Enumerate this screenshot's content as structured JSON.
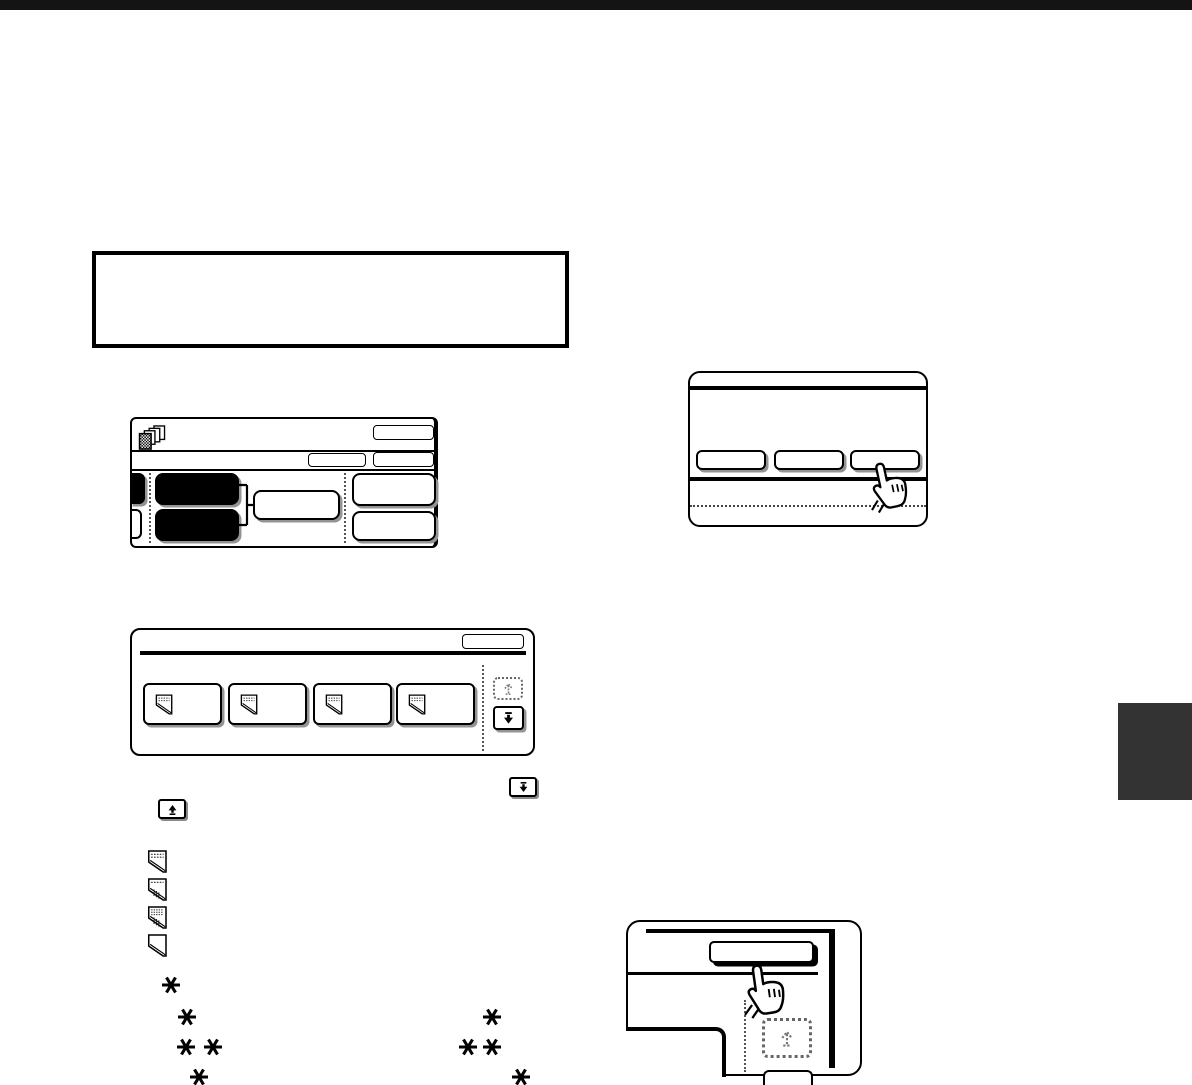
{
  "page": {
    "background": "#ffffff",
    "top_rule_color": "#141414",
    "side_tab_color": "#333333",
    "ink_color": "#000000",
    "visible_text": ""
  },
  "callout_box": {
    "text": ""
  },
  "figures": {
    "copier_screen": {
      "corner_icon": "stacked-copies-icon",
      "top_right_buttons": 3,
      "highlighted_black_keys": 2,
      "white_keys": 3,
      "bracket": "brace-link"
    },
    "button_row_panel": {
      "buttons": 3,
      "cursor": "pointing-hand-icon",
      "pressed_button_index": 3
    },
    "file_list_panel": {
      "file_buttons": 4,
      "file_icon": "document-dogear-icon",
      "scroll_up_state": "disabled",
      "scroll_down_state": "enabled"
    },
    "store_panel": {
      "cursor": "pointing-hand-icon",
      "top_button_pressed": true,
      "scroll_up_state": "disabled"
    }
  },
  "inline_icons": {
    "scroll_down": "scroll-to-bottom-icon",
    "scroll_up": "scroll-to-top-icon",
    "documents": [
      "document-text-icon",
      "document-chart-icon",
      "document-dense-icon",
      "document-plain-icon"
    ]
  },
  "asterisks": {
    "style": "six-spoked",
    "left_group_count": 5,
    "right_group_count": 4
  }
}
